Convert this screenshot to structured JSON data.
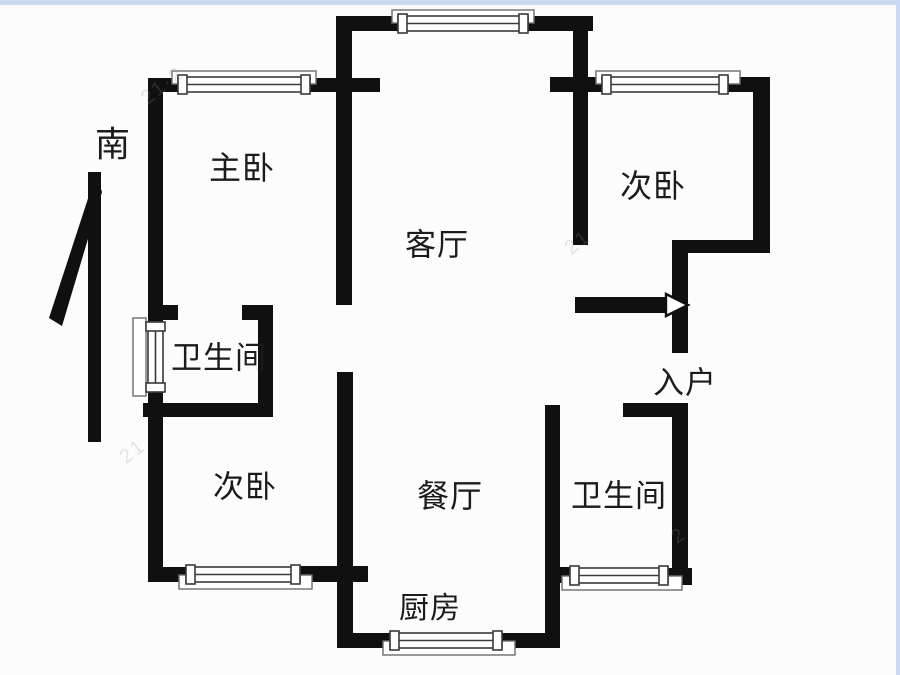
{
  "canvas": {
    "width": 900,
    "height": 675,
    "bg_color": "#fcfcfd",
    "wall_color": "#101010",
    "window_line_color": "#3a3a3a",
    "sill_line_color": "#6d6d6d",
    "border_color": "#ccd8f2",
    "label_color": "#1b1b1b"
  },
  "compass": {
    "label": "南",
    "x": 113,
    "y": 145,
    "size": 35
  },
  "rooms": [
    {
      "name": "master-bedroom",
      "label": "主卧",
      "x": 242,
      "y": 168,
      "size": 32
    },
    {
      "name": "bedroom-top-right",
      "label": "次卧",
      "x": 653,
      "y": 186,
      "size": 32
    },
    {
      "name": "living-room",
      "label": "客厅",
      "x": 437,
      "y": 245,
      "size": 31
    },
    {
      "name": "bathroom-left",
      "label": "卫生间",
      "x": 219,
      "y": 358,
      "size": 31
    },
    {
      "name": "bedroom-bottom-left",
      "label": "次卧",
      "x": 245,
      "y": 487,
      "size": 31
    },
    {
      "name": "dining-room",
      "label": "餐厅",
      "x": 450,
      "y": 496,
      "size": 32
    },
    {
      "name": "bathroom-right",
      "label": "卫生间",
      "x": 619,
      "y": 496,
      "size": 31
    },
    {
      "name": "entrance",
      "label": "入户",
      "x": 685,
      "y": 383,
      "size": 31
    },
    {
      "name": "kitchen",
      "label": "厨房",
      "x": 430,
      "y": 609,
      "size": 30
    }
  ],
  "watermarks": [
    {
      "text": "21·2",
      "x": 163,
      "y": 86
    },
    {
      "text": "21",
      "x": 578,
      "y": 243
    },
    {
      "text": "2",
      "x": 679,
      "y": 536
    },
    {
      "text": "21",
      "x": 133,
      "y": 452
    }
  ],
  "floorplan": {
    "walls": [
      [
        148,
        78,
        15,
        246
      ],
      [
        148,
        78,
        30,
        14
      ],
      [
        310,
        78,
        70,
        14
      ],
      [
        337,
        16,
        61,
        15
      ],
      [
        528,
        16,
        65,
        15
      ],
      [
        336,
        16,
        16,
        289
      ],
      [
        573,
        16,
        15,
        229
      ],
      [
        550,
        77,
        52,
        15
      ],
      [
        728,
        77,
        42,
        15
      ],
      [
        753,
        77,
        17,
        173
      ],
      [
        672,
        240,
        98,
        13
      ],
      [
        672,
        240,
        16,
        113
      ],
      [
        575,
        297,
        93,
        16
      ],
      [
        623,
        403,
        65,
        14
      ],
      [
        672,
        403,
        16,
        167
      ],
      [
        664,
        568,
        28,
        17
      ],
      [
        545,
        405,
        15,
        243
      ],
      [
        557,
        567,
        14,
        16
      ],
      [
        337,
        633,
        53,
        15
      ],
      [
        502,
        633,
        58,
        15
      ],
      [
        337,
        372,
        16,
        276
      ],
      [
        148,
        305,
        30,
        15
      ],
      [
        242,
        305,
        31,
        15
      ],
      [
        258,
        305,
        15,
        112
      ],
      [
        143,
        403,
        130,
        14
      ],
      [
        148,
        390,
        15,
        192
      ],
      [
        148,
        567,
        38,
        15
      ],
      [
        300,
        566,
        68,
        16
      ]
    ],
    "windows": [
      {
        "dir": "h",
        "opening": [
          178,
          77,
          132,
          15
        ],
        "sill": [
          172,
          71,
          144,
          13
        ]
      },
      {
        "dir": "h",
        "opening": [
          398,
          16,
          130,
          15
        ],
        "sill": [
          392,
          10,
          142,
          13
        ]
      },
      {
        "dir": "h",
        "opening": [
          602,
          77,
          126,
          15
        ],
        "sill": [
          596,
          71,
          144,
          13
        ]
      },
      {
        "dir": "v",
        "opening": [
          148,
          322,
          15,
          70
        ],
        "sill": [
          133,
          318,
          13,
          78
        ]
      },
      {
        "dir": "h",
        "opening": [
          186,
          567,
          114,
          15
        ],
        "sill": [
          179,
          575,
          133,
          14
        ]
      },
      {
        "dir": "h",
        "opening": [
          390,
          633,
          112,
          15
        ],
        "sill": [
          383,
          641,
          132,
          14
        ]
      },
      {
        "dir": "h",
        "opening": [
          570,
          568,
          98,
          15
        ],
        "sill": [
          562,
          576,
          120,
          14
        ]
      }
    ],
    "entrance_arrow": {
      "points": "666,294 688,305 666,316"
    },
    "compass_arrow": {
      "bar": [
        88,
        172,
        13,
        270
      ],
      "blade": "96,174 49,318 62,326 102,192"
    }
  }
}
